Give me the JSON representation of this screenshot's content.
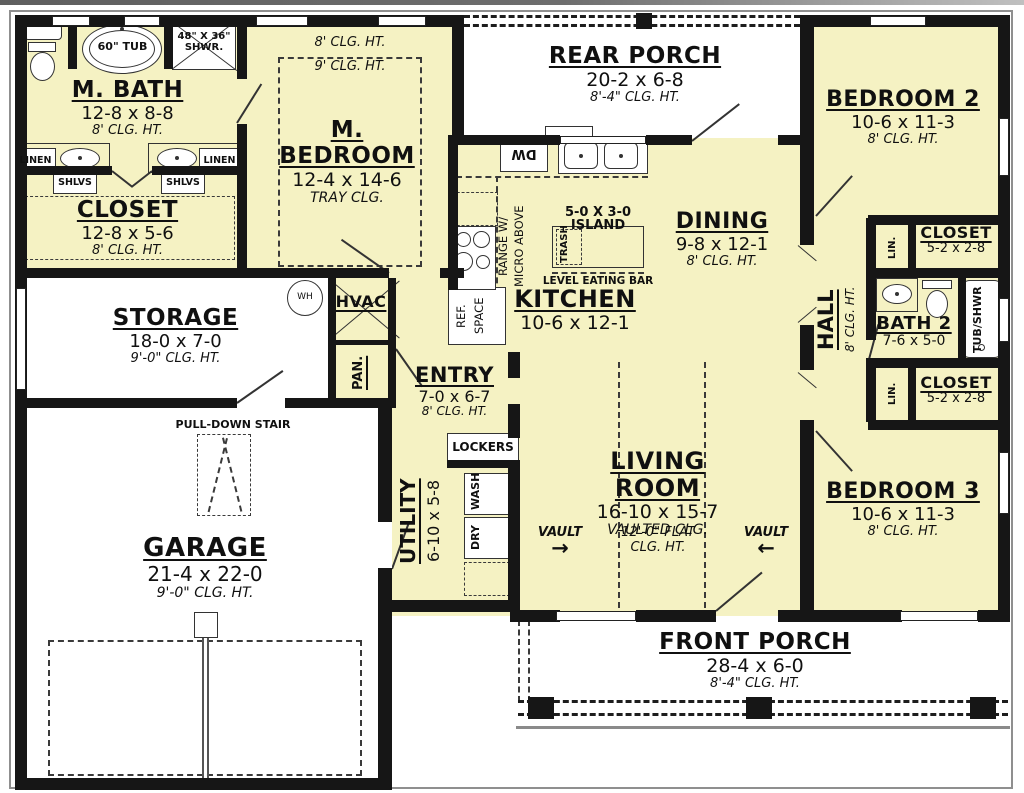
{
  "rooms": {
    "m_bath": {
      "title": "M. BATH",
      "dims": "12-8 x 8-8",
      "clg": "8' CLG. HT."
    },
    "m_closet": {
      "title": "CLOSET",
      "dims": "12-8 x 5-6",
      "clg": "8' CLG. HT."
    },
    "m_bedroom": {
      "title": "M. BEDROOM",
      "dims": "12-4 x 14-6",
      "clg": "TRAY CLG.",
      "clg_outer": "8' CLG. HT.",
      "clg_inner": "9' CLG. HT."
    },
    "rear_porch": {
      "title": "REAR PORCH",
      "dims": "20-2 x 6-8",
      "clg": "8'-4\" CLG. HT."
    },
    "bedroom2": {
      "title": "BEDROOM 2",
      "dims": "10-6 x 11-3",
      "clg": "8' CLG. HT."
    },
    "dining": {
      "title": "DINING",
      "dims": "9-8 x 12-1",
      "clg": "8' CLG. HT."
    },
    "kitchen": {
      "title": "KITCHEN",
      "dims": "10-6 x 12-1"
    },
    "storage": {
      "title": "STORAGE",
      "dims": "18-0 x 7-0",
      "clg": "9'-0\" CLG. HT."
    },
    "entry": {
      "title": "ENTRY",
      "dims": "7-0 x 6-7",
      "clg": "8' CLG. HT."
    },
    "living_room": {
      "title": "LIVING ROOM",
      "dims": "16-10 x 15-7",
      "clg": "VAULTED CLG.",
      "vault": "VAULT",
      "flat_line1": "12'-0\" FLAT",
      "flat_line2": "CLG. HT."
    },
    "utility": {
      "title": "UTILITY",
      "dims": "6-10 x 5-8"
    },
    "garage": {
      "title": "GARAGE",
      "dims": "21-4 x 22-0",
      "clg": "9'-0\" CLG. HT."
    },
    "bedroom3": {
      "title": "BEDROOM 3",
      "dims": "10-6 x 11-3",
      "clg": "8' CLG. HT."
    },
    "front_porch": {
      "title": "FRONT PORCH",
      "dims": "28-4 x 6-0",
      "clg": "8'-4\" CLG. HT."
    },
    "hall": {
      "title": "HALL",
      "clg": "8' CLG. HT."
    },
    "bath2": {
      "title": "BATH 2",
      "dims": "7-6 x 5-0"
    },
    "closet_small": {
      "title": "CLOSET",
      "dims": "5-2 x 2-8"
    }
  },
  "fixtures": {
    "tub": "60\" TUB",
    "shower_line1": "48\" X 36\"",
    "shower_line2": "SHWR.",
    "linen": "LINEN",
    "shlvs": "SHLVS",
    "lin": "LIN.",
    "tub_shwr": "TUB/SHWR",
    "wh": "WH",
    "hvac": "HVAC",
    "pan": "PAN.",
    "ref_line1": "REF.",
    "ref_line2": "SPACE",
    "dw": "DW",
    "range_line1": "RANGE W/",
    "range_line2": "MICRO ABOVE",
    "island": "5-0 X 3-0 ISLAND",
    "trash": "TRASH",
    "eating_bar": "LEVEL EATING BAR",
    "lockers": "LOCKERS",
    "wash": "WASH",
    "dry": "DRY",
    "pull_down": "PULL-DOWN STAIR"
  },
  "icons": {
    "vault_arrow_right": "→",
    "vault_arrow_left": "←"
  },
  "colors": {
    "floor": "#f5f2c3",
    "wall": "#161616",
    "porch": "#ffffff"
  }
}
